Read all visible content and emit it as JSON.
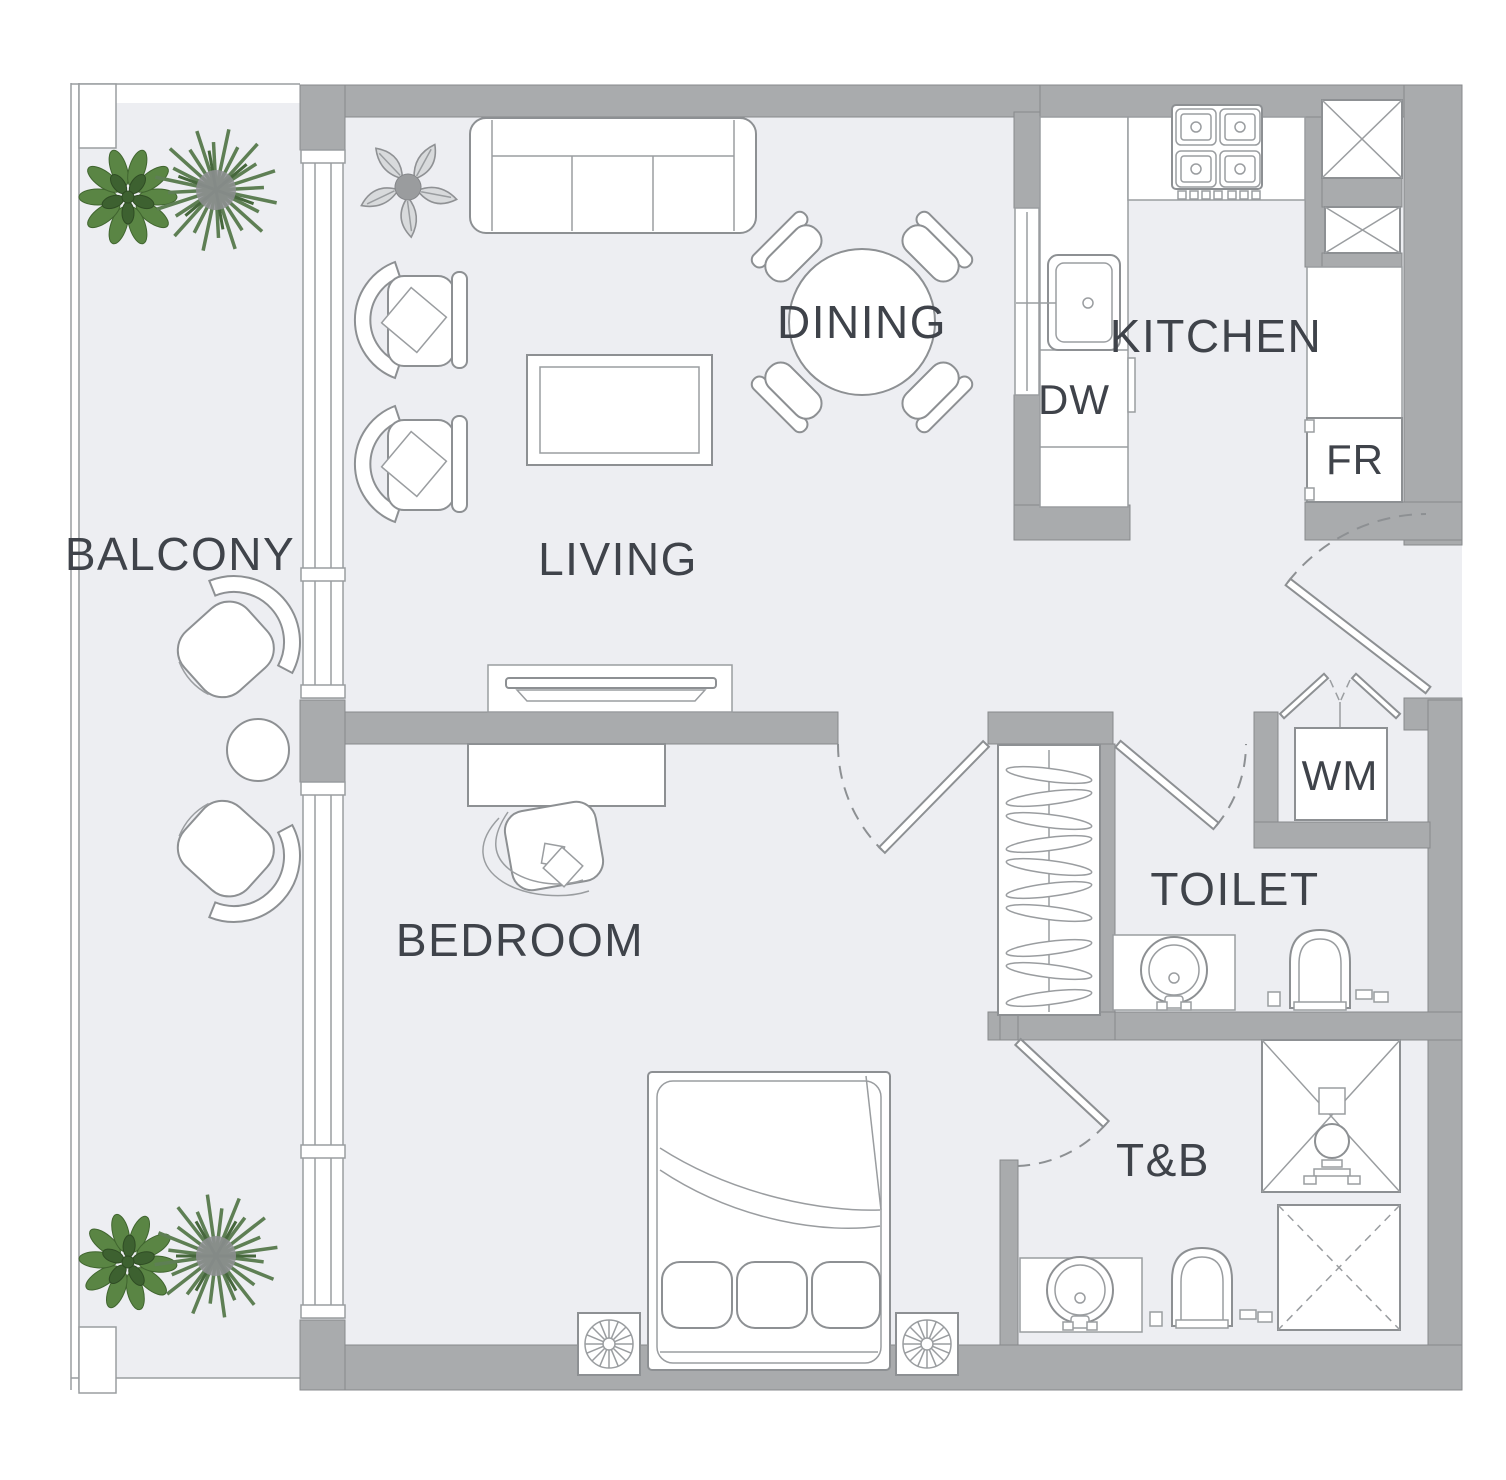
{
  "plan": {
    "type": "apartment-floor-plan",
    "labels": {
      "balcony": "BALCONY",
      "living": "LIVING",
      "dining": "DINING",
      "kitchen": "KITCHEN",
      "bedroom": "BEDROOM",
      "toilet": "TOILET",
      "tb": "T&B",
      "dishwasher": "DW",
      "fridge": "FR",
      "washing_machine": "WM"
    },
    "fixtures_visible": [
      "sofa",
      "armchairs",
      "coffee-table",
      "tv-console",
      "round-dining-table",
      "dining-chairs",
      "potted-plants",
      "stove-4-burner",
      "kitchen-sink",
      "dishwasher",
      "fridge",
      "duct-shafts",
      "entry-door",
      "bifold-closet-doors",
      "washing-machine",
      "wardrobe-with-hangers",
      "desk",
      "desk-chair",
      "double-bed",
      "nightstands",
      "washbasins",
      "toilet-bowls",
      "shower",
      "balcony-chairs",
      "balcony-round-table"
    ],
    "colors": {
      "wall": "#a9abad",
      "floor": "#edeef2",
      "outline": "#8d9093",
      "text": "#3f434a",
      "plant_green": "#5a8544",
      "palm_green": "#5e7f54",
      "sketch_gray": "#8f9194"
    }
  }
}
